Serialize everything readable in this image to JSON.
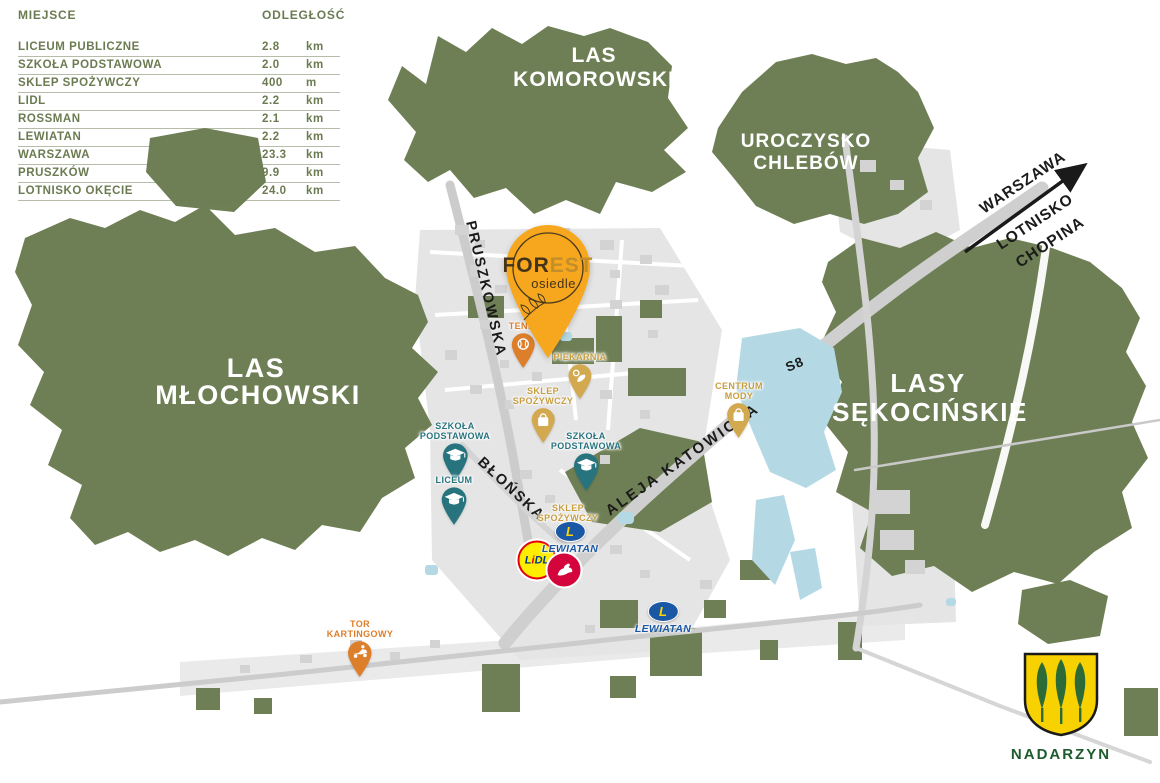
{
  "distance_table": {
    "header_place": "MIEJSCE",
    "header_distance": "ODLEGŁOŚĆ",
    "rows": [
      {
        "place": "LICEUM PUBLICZNE",
        "value": "2.8",
        "unit": "km"
      },
      {
        "place": "SZKOŁA PODSTAWOWA",
        "value": "2.0",
        "unit": "km"
      },
      {
        "place": "SKLEP SPOŻYWCZY",
        "value": "400",
        "unit": "m"
      },
      {
        "place": "LIDL",
        "value": "2.2",
        "unit": "km"
      },
      {
        "place": "ROSSMAN",
        "value": "2.1",
        "unit": "km"
      },
      {
        "place": "LEWIATAN",
        "value": "2.2",
        "unit": "km"
      },
      {
        "place": "WARSZAWA",
        "value": "23.3",
        "unit": "km"
      },
      {
        "place": "PRUSZKÓW",
        "value": "9.9",
        "unit": "km"
      },
      {
        "place": "LOTNISKO OKĘCIE",
        "value": "24.0",
        "unit": "km"
      }
    ]
  },
  "forests": {
    "komorowski_line1": "LAS",
    "komorowski_line2": "KOMOROWSKI",
    "chlebow_line1": "UROCZYSKO",
    "chlebow_line2": "CHLEBÓW",
    "mlochowski_line1": "LAS",
    "mlochowski_line2": "MŁOCHOWSKI",
    "sekocinskie_line1": "LASY",
    "sekocinskie_line2": "SĘKOCIŃSKIE"
  },
  "roads": {
    "pruszkowska": "PRUSZKOWSKA",
    "blonska": "BŁOŃSKA",
    "katowicka": "ALEJA KATOWICKA",
    "s8": "S8"
  },
  "direction": {
    "city": "WARSZAWA",
    "airport_line1": "LOTNISKO",
    "airport_line2": "CHOPINA"
  },
  "forest_pin": {
    "brand_for": "FOR",
    "brand_est": "EST",
    "brand_sub": "osiedle"
  },
  "pois": {
    "tenis": {
      "line1": "TENIS"
    },
    "piekarnia": {
      "line1": "PIEKARNIA"
    },
    "sklep_spozywczy_1": {
      "line1": "SKLEP",
      "line2": "SPOŻYWCZY"
    },
    "szkola_podstawowa_1": {
      "line1": "SZKOŁA",
      "line2": "PODSTAWOWA"
    },
    "liceum": {
      "line1": "LICEUM"
    },
    "szkola_podstawowa_2": {
      "line1": "SZKOŁA",
      "line2": "PODSTAWOWA"
    },
    "sklep_spozywczy_2": {
      "line1": "SKLEP",
      "line2": "SPOŻYWCZY"
    },
    "centrum_mody": {
      "line1": "CENTRUM",
      "line2": "MODY"
    },
    "tor_kartingowy": {
      "line1": "TOR",
      "line2": "KARTINGOWY"
    }
  },
  "logos": {
    "lidl_l": "L",
    "lidl_i": "i",
    "lidl_dl": "DL",
    "lewiatan_letter": "L",
    "lewiatan_name": "LEWIATAN"
  },
  "crest": {
    "municipality": "NADARZYN"
  },
  "colors": {
    "forest_green": "#6F7F55",
    "accent_orange": "#DD7E2A",
    "accent_gold": "#D3A94F",
    "accent_teal": "#27747F",
    "pin_amber": "#F6A71D",
    "lewiatan_blue": "#1A57A5",
    "lidl_yellow": "#FFED00",
    "rossmann_red": "#D4043C",
    "water_blue": "#B5D9E4",
    "crest_yellow": "#F8D200"
  }
}
